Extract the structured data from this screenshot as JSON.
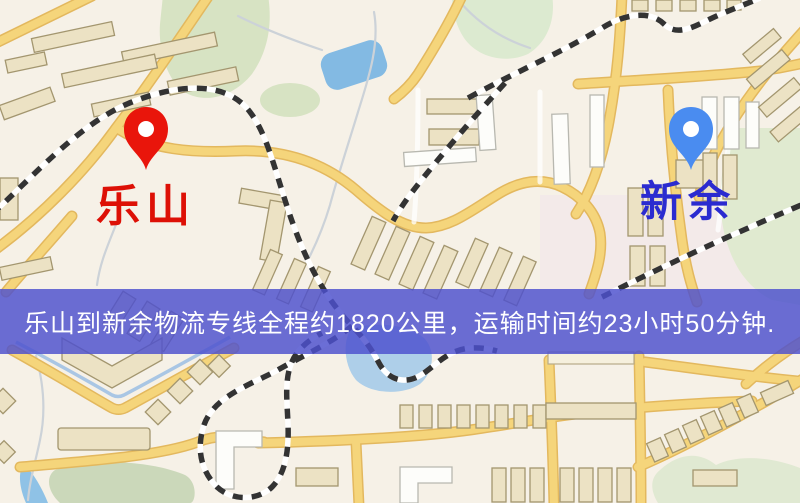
{
  "window": {
    "width": 800,
    "height": 503,
    "kind": "static-route-map-image"
  },
  "map": {
    "markers": [
      {
        "id": "origin",
        "label": "乐山",
        "pin_color": "#e9150b",
        "pin_hole_color": "#ffffff",
        "label_color": "#dd1006",
        "position": "left"
      },
      {
        "id": "destination",
        "label": "新余",
        "pin_color": "#4a8cf0",
        "pin_hole_color": "#ffffff",
        "label_color": "#2b2bd0",
        "position": "right"
      }
    ],
    "palette": {
      "background": "#f6f1e7",
      "road": "#f5d57b",
      "road_casing": "#e3b85e",
      "building": "#ece2c4",
      "building_outline": "#a3966f",
      "park_green": "#d7e3c3",
      "park_green_muted": "#cbd8ba",
      "water_blue": "#83bae3",
      "water_blue_light": "#aecfe9",
      "railway": "#333333"
    }
  },
  "banner": {
    "text": "乐山到新余物流专线全程约1820公里，运输时间约23小时50分钟.",
    "background": "#4d51ce",
    "text_color": "#ffffff"
  }
}
